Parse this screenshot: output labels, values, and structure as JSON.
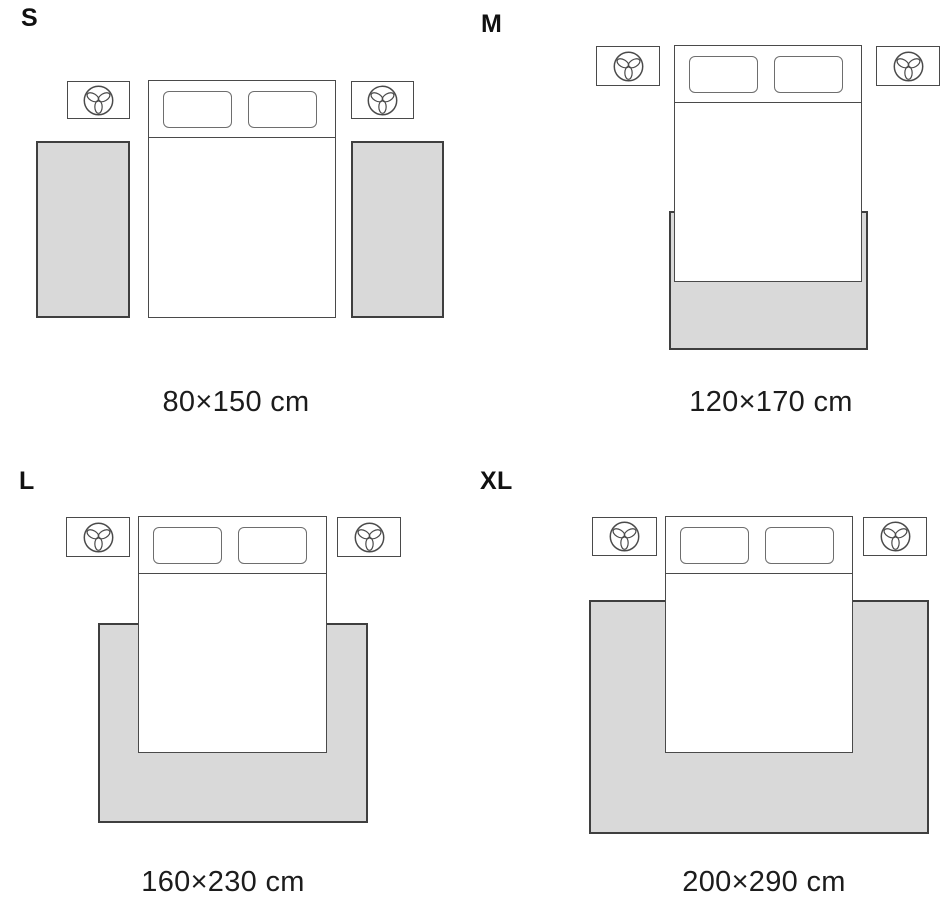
{
  "colors": {
    "background": "#ffffff",
    "rug_fill": "#d9d9d9",
    "outline": "#4a4a4a",
    "text": "#1c1c1c"
  },
  "icons": {
    "nightstand_decoration": "plant-icon"
  },
  "sizes": [
    {
      "label": "S",
      "dimensions": "80×150 cm"
    },
    {
      "label": "M",
      "dimensions": "120×170 cm"
    },
    {
      "label": "L",
      "dimensions": "160×230 cm"
    },
    {
      "label": "XL",
      "dimensions": "200×290 cm"
    }
  ]
}
